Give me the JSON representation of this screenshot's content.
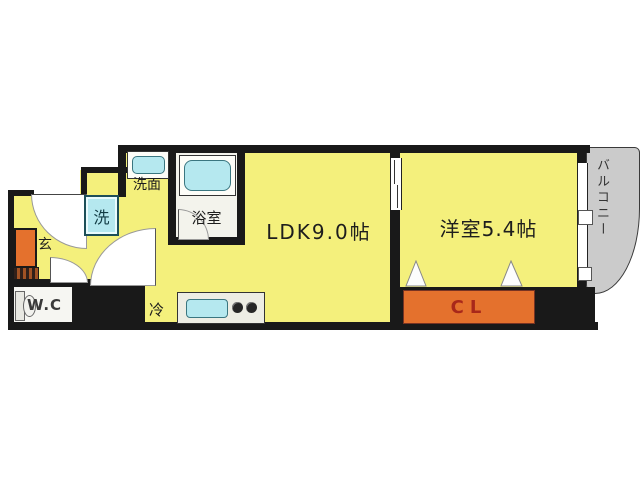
{
  "floorplan": {
    "labels": {
      "ldk": "LDK9.0帖",
      "bedroom": "洋室5.4帖",
      "closet": "CL",
      "balcony": "バルコニー",
      "washroom": "洗面",
      "bathroom": "浴室",
      "washing_machine": "洗",
      "entrance": "玄",
      "wc": "W.C",
      "refrigerator": "冷"
    },
    "colors": {
      "floor_yellow": "#f4f07c",
      "wall_black": "#191919",
      "accent_orange": "#e4712d",
      "fixture_cyan": "#b5e8ef",
      "balcony_gray": "#cbcbcb",
      "light_floor": "#f3f3ec",
      "closet_text_red": "#a8281a"
    }
  }
}
